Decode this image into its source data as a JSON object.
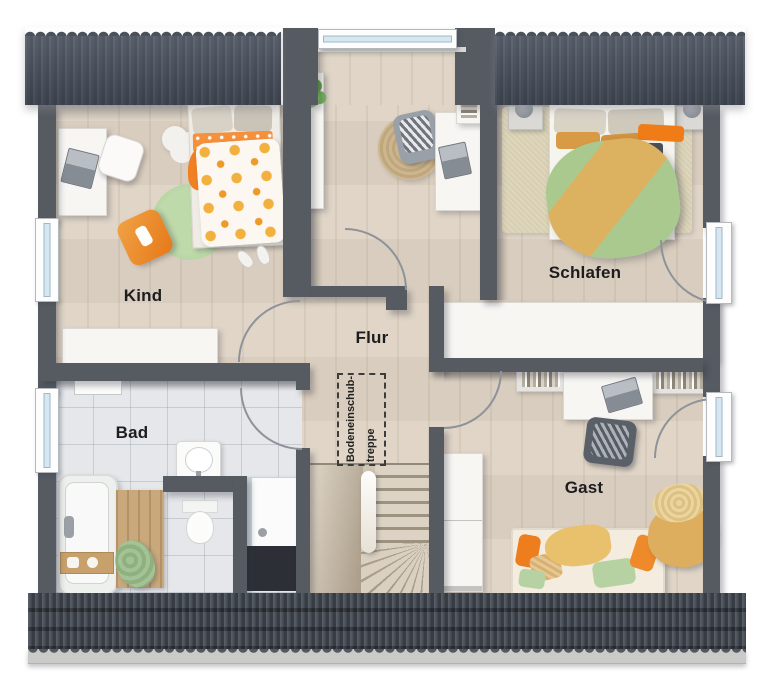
{
  "rooms": {
    "kind": "Kind",
    "schlafen": "Schlafen",
    "flur": "Flur",
    "bad": "Bad",
    "gast": "Gast"
  },
  "attic_stairs_label": {
    "line1": "Bodeneinschub-",
    "line2": "treppe"
  },
  "colors": {
    "wall": "#565b62",
    "roof": "#4a515c",
    "roof_bottom": "#4a505a",
    "floor_wood": "#ded3c4",
    "floor_tile": "#e5e7ea",
    "accent_orange": "#f07c17",
    "accent_ochre": "#d99a45",
    "accent_green": "#a9ca90",
    "window_glass": "#d6e7f2"
  }
}
